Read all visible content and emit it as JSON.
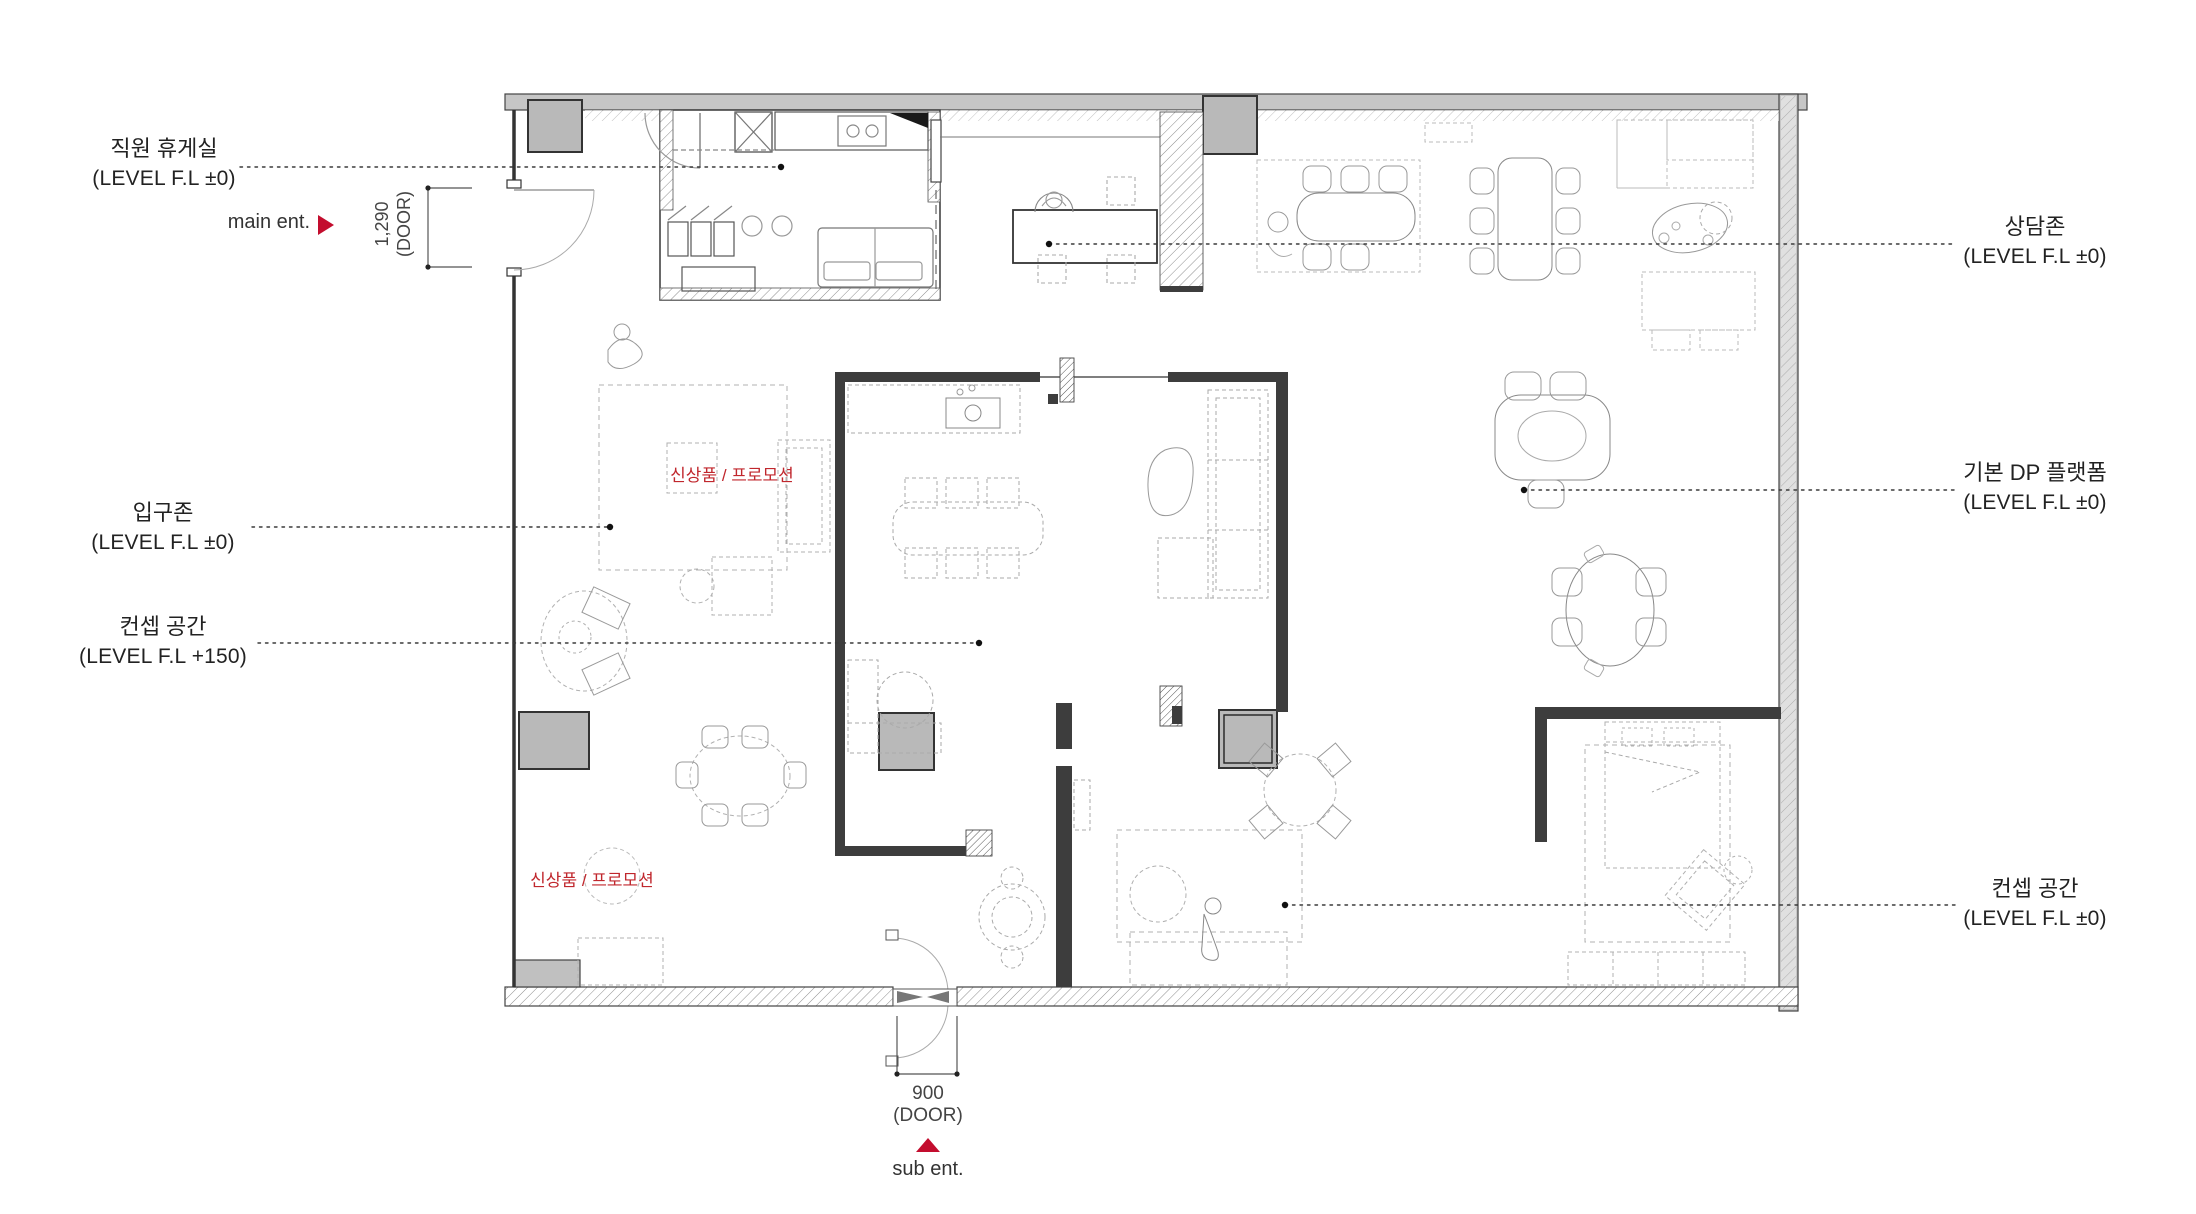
{
  "page": {
    "title": "showroom floor plan"
  },
  "colors": {
    "accent_red": "#c30d2e",
    "promo_red": "#c0272d",
    "wall_dark": "#3d3d3d",
    "wall_gray": "#c6c6c6"
  },
  "labels": {
    "staff_room": {
      "line1": "직원 휴게실",
      "line2": "(LEVEL F.L ±0)"
    },
    "main_ent": {
      "text": "main ent."
    },
    "door_main": {
      "line1": "1,290",
      "line2": "(DOOR)"
    },
    "consult_zone": {
      "line1": "상담존",
      "line2": "(LEVEL F.L ±0)"
    },
    "entrance_zone": {
      "line1": "입구존",
      "line2": "(LEVEL F.L ±0)"
    },
    "concept_150": {
      "line1": "컨셉 공간",
      "line2": "(LEVEL F.L +150)"
    },
    "dp_platform": {
      "line1": "기본 DP 플랫폼",
      "line2": "(LEVEL F.L ±0)"
    },
    "concept_0": {
      "line1": "컨셉 공간",
      "line2": "(LEVEL F.L ±0)"
    },
    "door_sub": {
      "line1": "900",
      "line2": "(DOOR)"
    },
    "sub_ent": {
      "text": "sub ent."
    },
    "promo_1": {
      "text": "신상품 / 프로모션"
    },
    "promo_2": {
      "text": "신상품 / 프로모션"
    }
  }
}
